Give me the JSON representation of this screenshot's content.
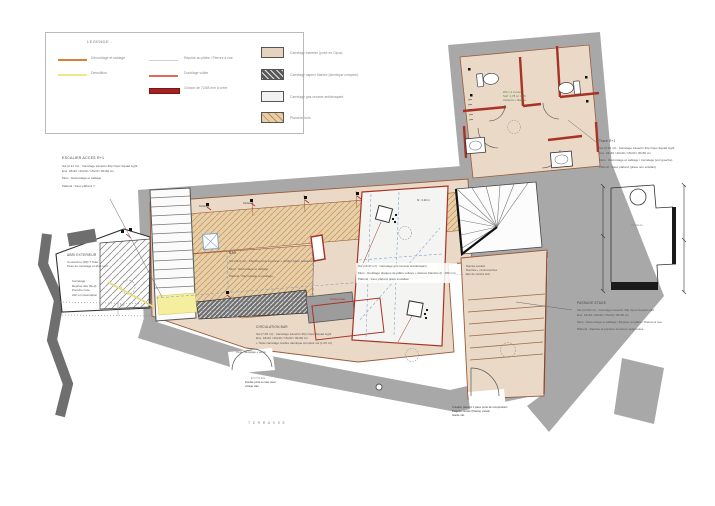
{
  "colors": {
    "wall_gray": "#a8a8a8",
    "dark_wall": "#6f6f6f",
    "travertine_beige": "#ead9c6",
    "wood_tan": "#e9cfa7",
    "tile_white": "#f4f4f2",
    "new_wall_red": "#a93226",
    "guide_blue": "#7b9fc7",
    "demolition_yellow": "#f6ee9f",
    "decroutage_orange": "#d4813b",
    "wc_note_green": "#4e7d3a"
  },
  "legend": {
    "title": "LEGENDE :",
    "line_items": [
      {
        "label": "Décroûtage et sablage"
      },
      {
        "label": "Démolition"
      },
      {
        "label": "Reprise au plâtre / Pierres à vue"
      },
      {
        "label": "Doublage voilée"
      },
      {
        "label": "Cloison de 72/48 mm à créer"
      }
    ],
    "swatch_items": [
      {
        "label": "Carrelage travertin (pose en Opus)"
      },
      {
        "label": "Carrelage aspect Marbre (identique comptoir)"
      },
      {
        "label": "Carrelage gris cérame antidérapant"
      },
      {
        "label": "Plancher bois"
      }
    ]
  },
  "annotations": {
    "escalier": {
      "title": "ESCALIER ACCES R+1",
      "lines": [
        "Sol (2.31 m²) : Carrelage travertin 30p Opus Squad Light",
        "Ens. 18x40 / 20x40 / 15x30 / 30x60 cm",
        "Murs : Décroûtage et sablage",
        "Plafond : Faux plafond ?"
      ]
    },
    "abri": {
      "title": "ABRI EXTERIEUR",
      "lines": [
        "Couverture (R0) ? Toile",
        "Pose de carrelage et abat vent"
      ],
      "lines2": [
        "Carrelage :",
        "Reprise dès (R+2)",
        "Prendre Cote",
        "Abri en réservation"
      ]
    },
    "bar": {
      "title": "BAR",
      "lines": [
        "Sol (31.6 m²) : Plancher bois à poncer + vitrifier (idem restaurant)",
        "Murs : Décroûtage et sablage",
        "Plafond : Décroûtage et ravalage"
      ]
    },
    "circulation": {
      "title": "CIRCULATION BAR",
      "lines": [
        "Sol (7.05 m²) : Carrelage travertin 30p Opus Squad Light",
        "Ens. 18x40 / 20x40 / 15x30 / 30x60 cm",
        "+ Tapis carrelage marbre identique comptoir sol (1.25 m²)"
      ]
    },
    "cuisine": {
      "lines": [
        "Sol (16.47 m²) : Carrelage gris cérame antidérapant",
        "Murs : Doublage plaques de plâtre voilées + faïence blanche (h : 180 cm)",
        "Plafond : Faux plafond placo à réaliser"
      ],
      "red_note": "À faire poser",
      "height_note": "ht : 2.20 m"
    },
    "wc": {
      "lines": [
        "WC x 2 à créer",
        "Surf. 1.78 m² / WC",
        "Cloisons + faïence"
      ]
    },
    "palier": {
      "lines": [
        "Reprise escalier",
        "Marches + contremarches",
        "Nez de marche bois"
      ]
    },
    "passage": {
      "title": "PASSAGE ETAGE",
      "lines": [
        "Sol (13.90 m²) : Carrelage travertin 30p Opus Squad Light",
        "Ens. 18x40 / 20x40 / 15x30 / 30x60 cm",
        "Murs : Décroûtage et sablage / Reprise au plâtre / Pierres à vue",
        "Plafond : Reprise et peinture à pierres apparentes"
      ]
    },
    "trace": {
      "title": "Tracé R+1",
      "lines": [
        "Sol (8.35 m²) : Carrelage travertin 30p Opus Squad Light",
        "Ens. 18x40 / 20x40 / 15x30 / 30x60 cm",
        "Murs : Décroûtage et sablage / Carrelage (voir gauche)",
        "Plafond : Faux plafond (placo non existant)"
      ],
      "diagram_label": "Crédence"
    },
    "entree": {
      "door_note": "Porte : décapage + vernis",
      "label": "ENTREE",
      "lines": [
        "Double porte à créer avec",
        "vitrage clair"
      ]
    },
    "placard": {
      "lines": [
        "Création placard 1 place porte de récupération",
        "Poignée cintrée (Patère) vantail",
        "Garde nat."
      ]
    },
    "terrasse": "TERRASSE",
    "radiateur": "Radiateur",
    "dim_150": "150"
  }
}
